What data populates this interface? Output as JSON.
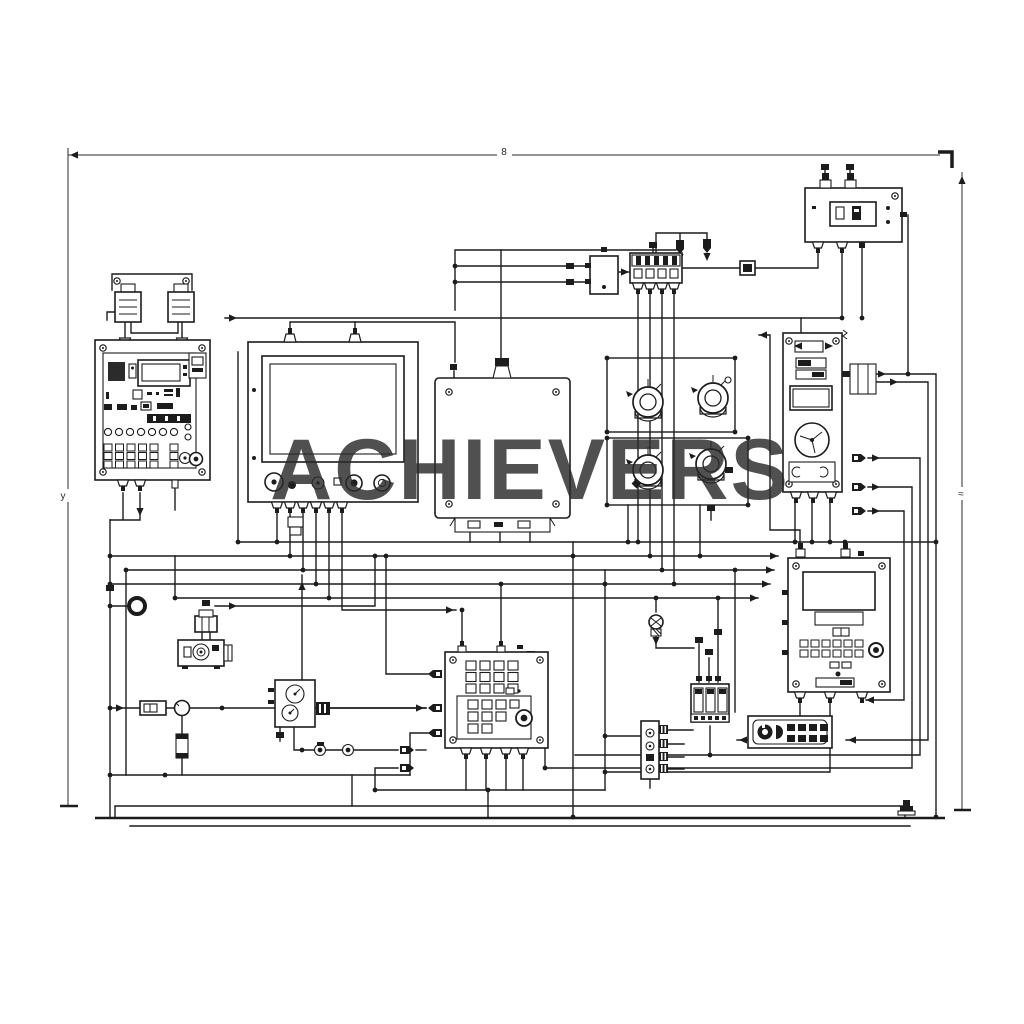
{
  "watermark": {
    "text": "ACHIEVERS"
  },
  "colors": {
    "ink": "#1c1c1c",
    "watermark": "#5c5c5c",
    "background": "#ffffff"
  },
  "dimension_labels": {
    "top": "8",
    "left": "y",
    "right": "≈"
  },
  "components": [
    {
      "id": "control-panel-unit",
      "kind": "operator control panel with keypad, indicator row and knobs"
    },
    {
      "id": "transformer-pair",
      "kind": "two transformers on mounting bracket"
    },
    {
      "id": "display-monitor-unit",
      "kind": "CRT monitor with front knobs and bottom connectors"
    },
    {
      "id": "junction-box",
      "kind": "sealed junction box with corner screws and bottom terminal strip"
    },
    {
      "id": "valve-motor-group",
      "kind": "four rotary valve/motor actuators in two frames"
    },
    {
      "id": "fan-control-panel",
      "kind": "tall panel with displays and cooling fan"
    },
    {
      "id": "meter-box",
      "kind": "top-right meter box with display and plugs"
    },
    {
      "id": "fuse-block",
      "kind": "striped fuse block with four pins"
    },
    {
      "id": "relay-module",
      "kind": "small relay with side pins"
    },
    {
      "id": "diode-pair",
      "kind": "two inline diodes"
    },
    {
      "id": "controller-unit",
      "kind": "bottom-right controller with display, keypad and button"
    },
    {
      "id": "keypad-unit",
      "kind": "bottom-center keypad box with knob"
    },
    {
      "id": "sensor-camera",
      "kind": "sensor with plug connector"
    },
    {
      "id": "gauge-module",
      "kind": "twin round gauges box"
    },
    {
      "id": "fuse-holder",
      "kind": "inline fuse holder and ring terminal"
    },
    {
      "id": "relay-block",
      "kind": "three-cell relay block"
    },
    {
      "id": "button-panel",
      "kind": "small button pad"
    },
    {
      "id": "terminal-strip",
      "kind": "vertical terminal strip with comb contacts"
    },
    {
      "id": "indicator-lamp",
      "kind": "indicator bulb"
    },
    {
      "id": "ground-rail",
      "kind": "stepped base/ground rail"
    },
    {
      "id": "dimension-lines",
      "kind": "overall dimension lines"
    }
  ]
}
